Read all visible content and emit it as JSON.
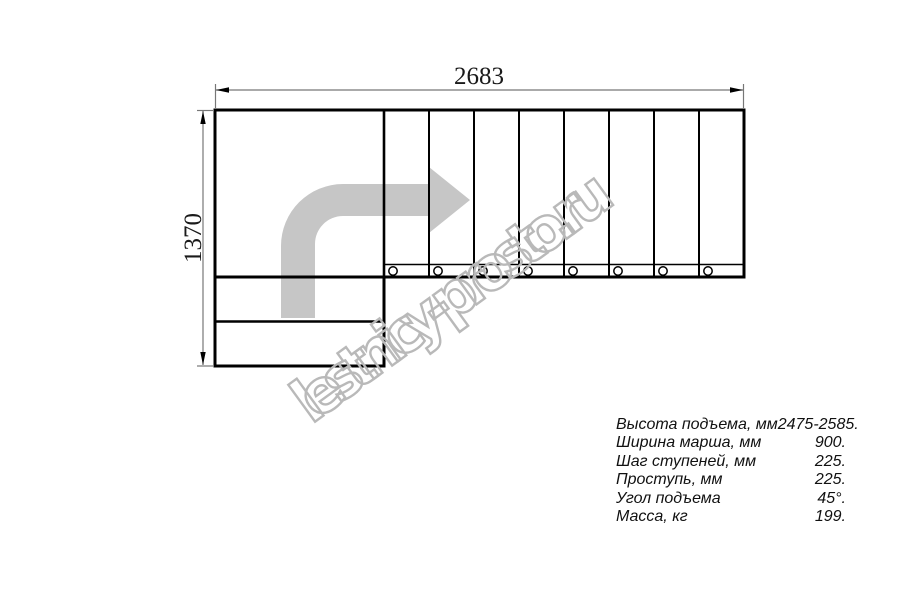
{
  "drawing": {
    "title": "L-shaped staircase plan view",
    "dim_width_label": "2683",
    "dim_height_label": "1370",
    "watermark": "lestnicy-prosto.ru",
    "steps_count": 8,
    "winder_steps_count": 2,
    "colors": {
      "line": "#000000",
      "dimension": "#777777",
      "direction_arrow": "#c6c6c6",
      "watermark": "#b9b9b9"
    }
  },
  "specs": {
    "rows": [
      {
        "label": "Высота подъема, мм",
        "value": "2475-2585."
      },
      {
        "label": "Ширина марша, мм",
        "value": "900."
      },
      {
        "label": "Шаг ступеней, мм",
        "value": "225."
      },
      {
        "label": "Проступь, мм",
        "value": "225."
      },
      {
        "label": "Угол подъема",
        "value": "45°."
      },
      {
        "label": "Масса, кг",
        "value": "199."
      }
    ]
  }
}
